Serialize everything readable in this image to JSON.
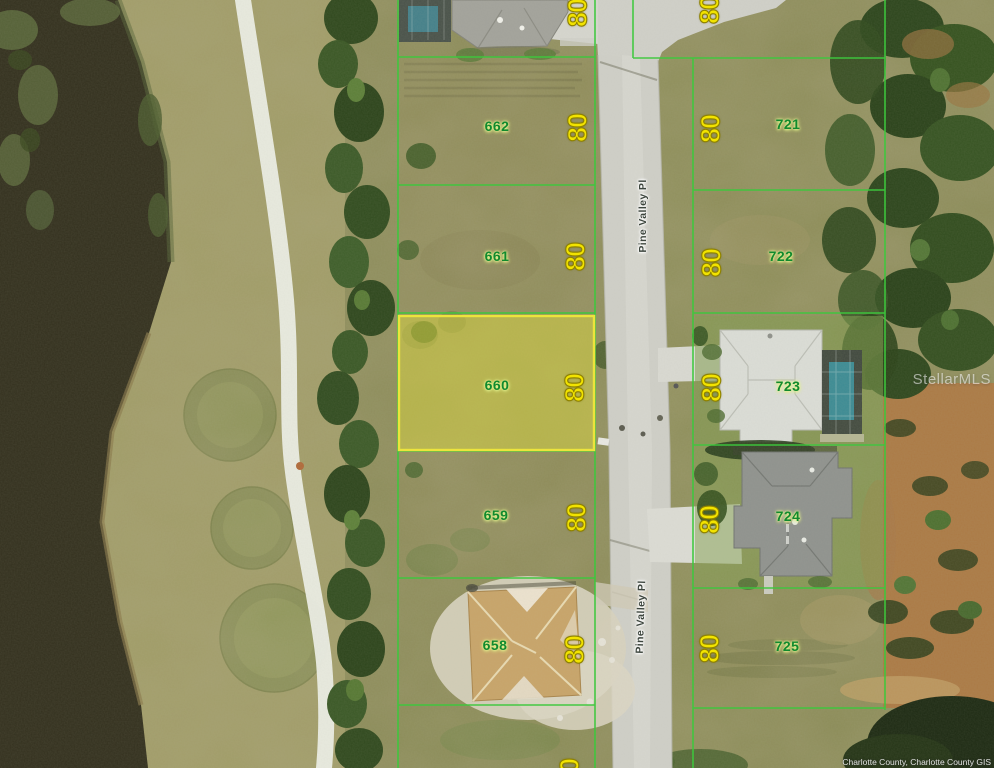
{
  "map_view": {
    "type": "aerial-parcel-map",
    "watermark": "StellarMLS",
    "attribution": "Charlotte County, Charlotte County GIS",
    "street_labels": [
      "Pine Valley Pl",
      "Pine Valley Pl"
    ],
    "highlighted_parcel": "660",
    "parcels": {
      "west": [
        {
          "number": "662",
          "frontage": "80",
          "highlighted": false
        },
        {
          "number": "661",
          "frontage": "80",
          "highlighted": false
        },
        {
          "number": "660",
          "frontage": "80",
          "highlighted": true
        },
        {
          "number": "659",
          "frontage": "80",
          "highlighted": false
        },
        {
          "number": "658",
          "frontage": "80",
          "highlighted": false
        }
      ],
      "east": [
        {
          "number": "721",
          "frontage": "80",
          "highlighted": false
        },
        {
          "number": "722",
          "frontage": "80",
          "highlighted": false
        },
        {
          "number": "723",
          "frontage": "80",
          "highlighted": false
        },
        {
          "number": "724",
          "frontage": "80",
          "highlighted": false
        },
        {
          "number": "725",
          "frontage": "80",
          "highlighted": false
        }
      ]
    },
    "partial_frontages": [
      "80",
      "80",
      "80"
    ],
    "colors": {
      "boundary_green": "#3dc83d",
      "highlight_yellow": "#ece43c",
      "lot_number_green": "#118a2e",
      "frontage_yellow": "#f2e300",
      "water": "#33301e",
      "road": "#cfcfc8"
    }
  }
}
